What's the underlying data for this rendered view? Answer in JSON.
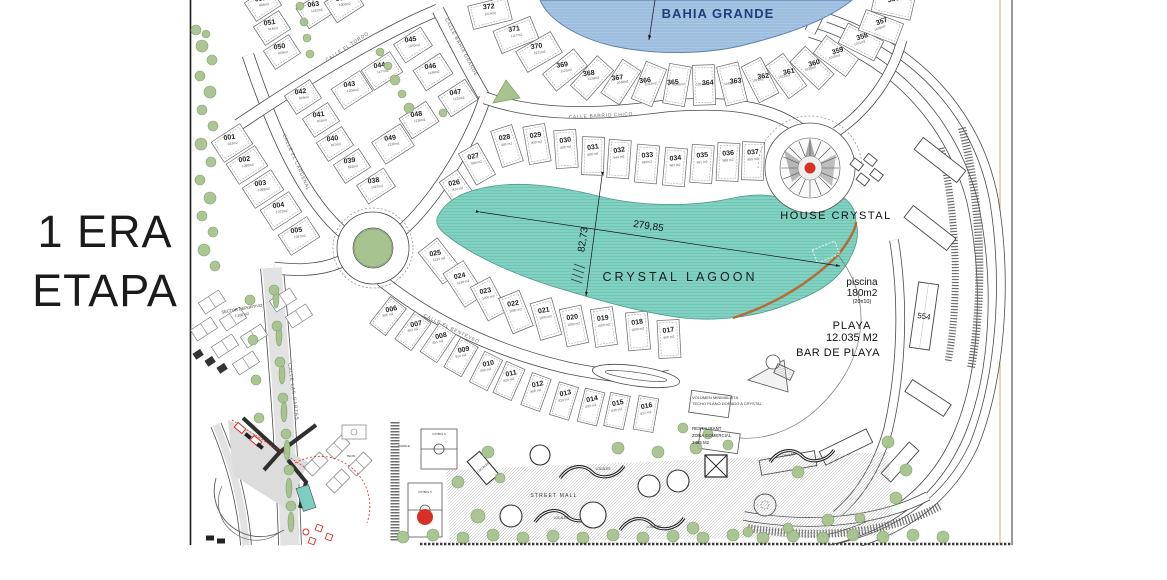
{
  "stage": {
    "line1": "1 ERA",
    "line2": "ETAPA"
  },
  "water": {
    "bahia": "BAHIA GRANDE",
    "lagoon": "CRYSTAL LAGOON",
    "length": "279,85",
    "width": "82,73"
  },
  "poi": {
    "house": "HOUSE CRYSTAL",
    "piscina1": "piscina",
    "piscina2": "180m2",
    "piscina3": "(20x10)",
    "playa1": "PLAYA",
    "playa2": "12.035 M2",
    "bar": "BAR DE PLAYA",
    "b554": "554",
    "rest1": "RESTAURANT",
    "rest2": "ZONA COMERCIAL",
    "rest3": "1485 M2",
    "vol1": "VOLUMEN MINIMALISTA",
    "vol2": "TECHO PLANO DORADO A CRYSTAL",
    "mall": "STREET MALL",
    "sector1": "SECTOR DEPORTIVO",
    "sector2": "7.100 m2",
    "futbol": "FUTBOL 5",
    "tenis": "TENIS",
    "paddle": "PADDLE",
    "locales": "LOCALES"
  },
  "streets": [
    {
      "name": "CALLE EL TORDO",
      "x": 160,
      "y": 48,
      "rot": -33
    },
    {
      "name": "CALLE BAHIA GRANDE",
      "x": 272,
      "y": 48,
      "rot": 62
    },
    {
      "name": "CALLE BARRIO CHICO",
      "x": 413,
      "y": 117,
      "rot": -3
    },
    {
      "name": "CALLE EL CARDENAL",
      "x": 107,
      "y": 163,
      "rot": 66
    },
    {
      "name": "CALLE EL BENTEVEO",
      "x": 263,
      "y": 330,
      "rot": 26
    },
    {
      "name": "CALLE LAS GARZAS",
      "x": 104,
      "y": 392,
      "rot": 82
    }
  ],
  "locales_positions": [
    {
      "x": 415,
      "y": 470,
      "rot": 0
    },
    {
      "x": 600,
      "y": 456,
      "rot": -8
    },
    {
      "x": 373,
      "y": 519,
      "rot": 0
    },
    {
      "x": 466,
      "y": 528,
      "rot": 0
    },
    {
      "x": 296,
      "y": 468,
      "rot": -40
    }
  ],
  "lots": {
    "fields": [
      "number",
      "area",
      "x",
      "y",
      "rot",
      "text_rot",
      "w",
      "h"
    ],
    "items": [
      [
        "001",
        "943m2",
        44,
        143,
        -33,
        -8,
        34,
        24
      ],
      [
        "002",
        "1088m2",
        59,
        165,
        -33,
        -8,
        34,
        24
      ],
      [
        "003",
        "1089m2",
        75,
        189,
        -33,
        -8,
        34,
        24
      ],
      [
        "004",
        "1072m2",
        93,
        211,
        -33,
        -8,
        34,
        24
      ],
      [
        "005",
        "1047m2",
        111,
        236,
        -33,
        -8,
        34,
        24
      ],
      [
        "038",
        "1027m2",
        188,
        186,
        -33,
        -8,
        32,
        22
      ],
      [
        "039",
        "922m2",
        164,
        166,
        -33,
        -8,
        30,
        22
      ],
      [
        "040",
        "917m2",
        147,
        144,
        -33,
        -8,
        30,
        22
      ],
      [
        "041",
        "831m2",
        133,
        120,
        -33,
        -8,
        30,
        22
      ],
      [
        "042",
        "918m2",
        115,
        97,
        -33,
        -8,
        30,
        22
      ],
      [
        "043",
        "1208m2",
        164,
        90,
        -33,
        -8,
        34,
        24
      ],
      [
        "044",
        "1177m2",
        194,
        71,
        -33,
        -8,
        34,
        24
      ],
      [
        "045",
        "1070m2",
        225,
        45,
        -33,
        -8,
        32,
        22
      ],
      [
        "046",
        "1146m2",
        245,
        72,
        -33,
        -8,
        32,
        24
      ],
      [
        "047",
        "1132m2",
        270,
        98,
        -33,
        -8,
        32,
        24
      ],
      [
        "048",
        "1138m2",
        231,
        120,
        -33,
        -8,
        32,
        24
      ],
      [
        "049",
        "1320m2",
        205,
        144,
        -33,
        -8,
        34,
        26
      ],
      [
        "050",
        "833m2",
        94,
        52,
        -33,
        -8,
        30,
        22
      ],
      [
        "051",
        "914m2",
        84,
        28,
        -33,
        -8,
        30,
        22
      ],
      [
        "052",
        "804m2",
        75,
        4,
        -33,
        -8,
        30,
        22
      ],
      [
        "063",
        "1142m2",
        128,
        10,
        -33,
        -8,
        32,
        24
      ],
      [
        "062",
        "1000m2",
        156,
        4,
        -33,
        -8,
        32,
        24
      ],
      [
        "372",
        "1214m2",
        302,
        13,
        -14,
        -6,
        40,
        24
      ],
      [
        "371",
        "1117m2",
        328,
        35,
        -22,
        -8,
        40,
        24
      ],
      [
        "370",
        "1131m2",
        351,
        52,
        -30,
        -8,
        40,
        24
      ],
      [
        "369",
        "1121m2",
        377,
        70,
        -39,
        -8,
        40,
        22
      ],
      [
        "368",
        "1138m2",
        404,
        78,
        -48,
        -8,
        40,
        22
      ],
      [
        "367",
        "1048m2",
        433,
        82,
        -57,
        -8,
        40,
        22
      ],
      [
        "366",
        "1012m2",
        461,
        84,
        -68,
        -6,
        40,
        22
      ],
      [
        "365",
        "1061m2",
        489,
        85,
        -80,
        -4,
        40,
        22
      ],
      [
        "364",
        "1021m2",
        516,
        85,
        88,
        -4,
        40,
        22
      ],
      [
        "363",
        "1048m2",
        544,
        84,
        76,
        -6,
        40,
        22
      ],
      [
        "362",
        "1021m2",
        572,
        80,
        63,
        -8,
        40,
        22
      ],
      [
        "361",
        "1022m2",
        598,
        76,
        54,
        -12,
        40,
        22
      ],
      [
        "360",
        "1039m2",
        624,
        68,
        44,
        -16,
        40,
        22
      ],
      [
        "359",
        "1019m2",
        648,
        56,
        36,
        -18,
        40,
        22
      ],
      [
        "358",
        "1011m2",
        673,
        42,
        27,
        -18,
        40,
        22
      ],
      [
        "357",
        "1039m2",
        693,
        27,
        21,
        -20,
        40,
        22
      ],
      [
        "356",
        "",
        705,
        5,
        13,
        -12,
        40,
        22
      ],
      [
        "026",
        "824 m2",
        270,
        190,
        -35,
        -10,
        22,
        34
      ],
      [
        "027",
        "900 m2",
        289,
        164,
        -30,
        -12,
        22,
        36
      ],
      [
        "028",
        "900 m2",
        319,
        146,
        -18,
        -10,
        22,
        38
      ],
      [
        "029",
        "800 m2",
        349,
        144,
        -10,
        -8,
        22,
        38
      ],
      [
        "030",
        "800 m2",
        378,
        149,
        -4,
        -8,
        22,
        38
      ],
      [
        "031",
        "800 m2",
        405,
        156,
        2,
        -8,
        22,
        38
      ],
      [
        "032",
        "944 m2",
        431,
        159,
        4,
        -8,
        22,
        38
      ],
      [
        "033",
        "987m2",
        459,
        164,
        5,
        -5,
        22,
        38
      ],
      [
        "034",
        "987 m2",
        487,
        167,
        5,
        -5,
        22,
        38
      ],
      [
        "035",
        "991 m2",
        514,
        164,
        4,
        -5,
        22,
        38
      ],
      [
        "036",
        "988 m2",
        540,
        162,
        3,
        -5,
        22,
        38
      ],
      [
        "037",
        "905 m2",
        565,
        161,
        2,
        -5,
        22,
        38
      ],
      [
        "025",
        "1133 m2",
        252,
        261,
        -38,
        -10,
        24,
        40
      ],
      [
        "024",
        "1138 m2",
        276,
        284,
        -33,
        -12,
        24,
        40
      ],
      [
        "023",
        "1000 m2",
        301,
        299,
        -28,
        -12,
        22,
        38
      ],
      [
        "022",
        "1000 m2",
        328,
        312,
        -22,
        -10,
        22,
        38
      ],
      [
        "021",
        "1000 m2",
        358,
        319,
        -16,
        -10,
        22,
        38
      ],
      [
        "020",
        "1000 m2",
        386,
        326,
        -12,
        -8,
        22,
        38
      ],
      [
        "019",
        "1000 m2",
        416,
        327,
        -8,
        -8,
        22,
        38
      ],
      [
        "018",
        "1000 m2",
        450,
        331,
        -5,
        -8,
        22,
        38
      ],
      [
        "017",
        "900 m2",
        481,
        339,
        -3,
        -8,
        22,
        38
      ],
      [
        "006",
        "805 m2",
        200,
        316,
        38,
        -12,
        20,
        34
      ],
      [
        "007",
        "802 m2",
        225,
        331,
        36,
        -12,
        20,
        34
      ],
      [
        "008",
        "851 m2",
        250,
        343,
        34,
        -12,
        20,
        34
      ],
      [
        "009",
        "914 m2",
        273,
        357,
        30,
        -12,
        20,
        34
      ],
      [
        "010",
        "809 m2",
        298,
        371,
        27,
        -12,
        20,
        34
      ],
      [
        "011",
        "820 m2",
        321,
        381,
        24,
        -12,
        20,
        34
      ],
      [
        "012",
        "808 m2",
        348,
        392,
        20,
        -12,
        20,
        34
      ],
      [
        "013",
        "824 m2",
        376,
        401,
        17,
        -12,
        20,
        34
      ],
      [
        "014",
        "833 m2",
        403,
        407,
        14,
        -12,
        20,
        34
      ],
      [
        "015",
        "830 m2",
        429,
        411,
        12,
        -12,
        20,
        34
      ],
      [
        "016",
        "837 m2",
        458,
        414,
        10,
        -12,
        20,
        34
      ]
    ]
  },
  "colors": {
    "bahia": "#a9c6e4",
    "bahia_stripe": "#8fb2d6",
    "bahia_edge": "#5d82b0",
    "lagoon": "#83d1c0",
    "lagoon_stripe": "#68c2af",
    "shore": "#b76b34",
    "green": "#a7c38f",
    "green_dark": "#7c9f63",
    "red": "#d93025",
    "navy": "#1e3e7c",
    "ink": "#1a1a1a"
  }
}
